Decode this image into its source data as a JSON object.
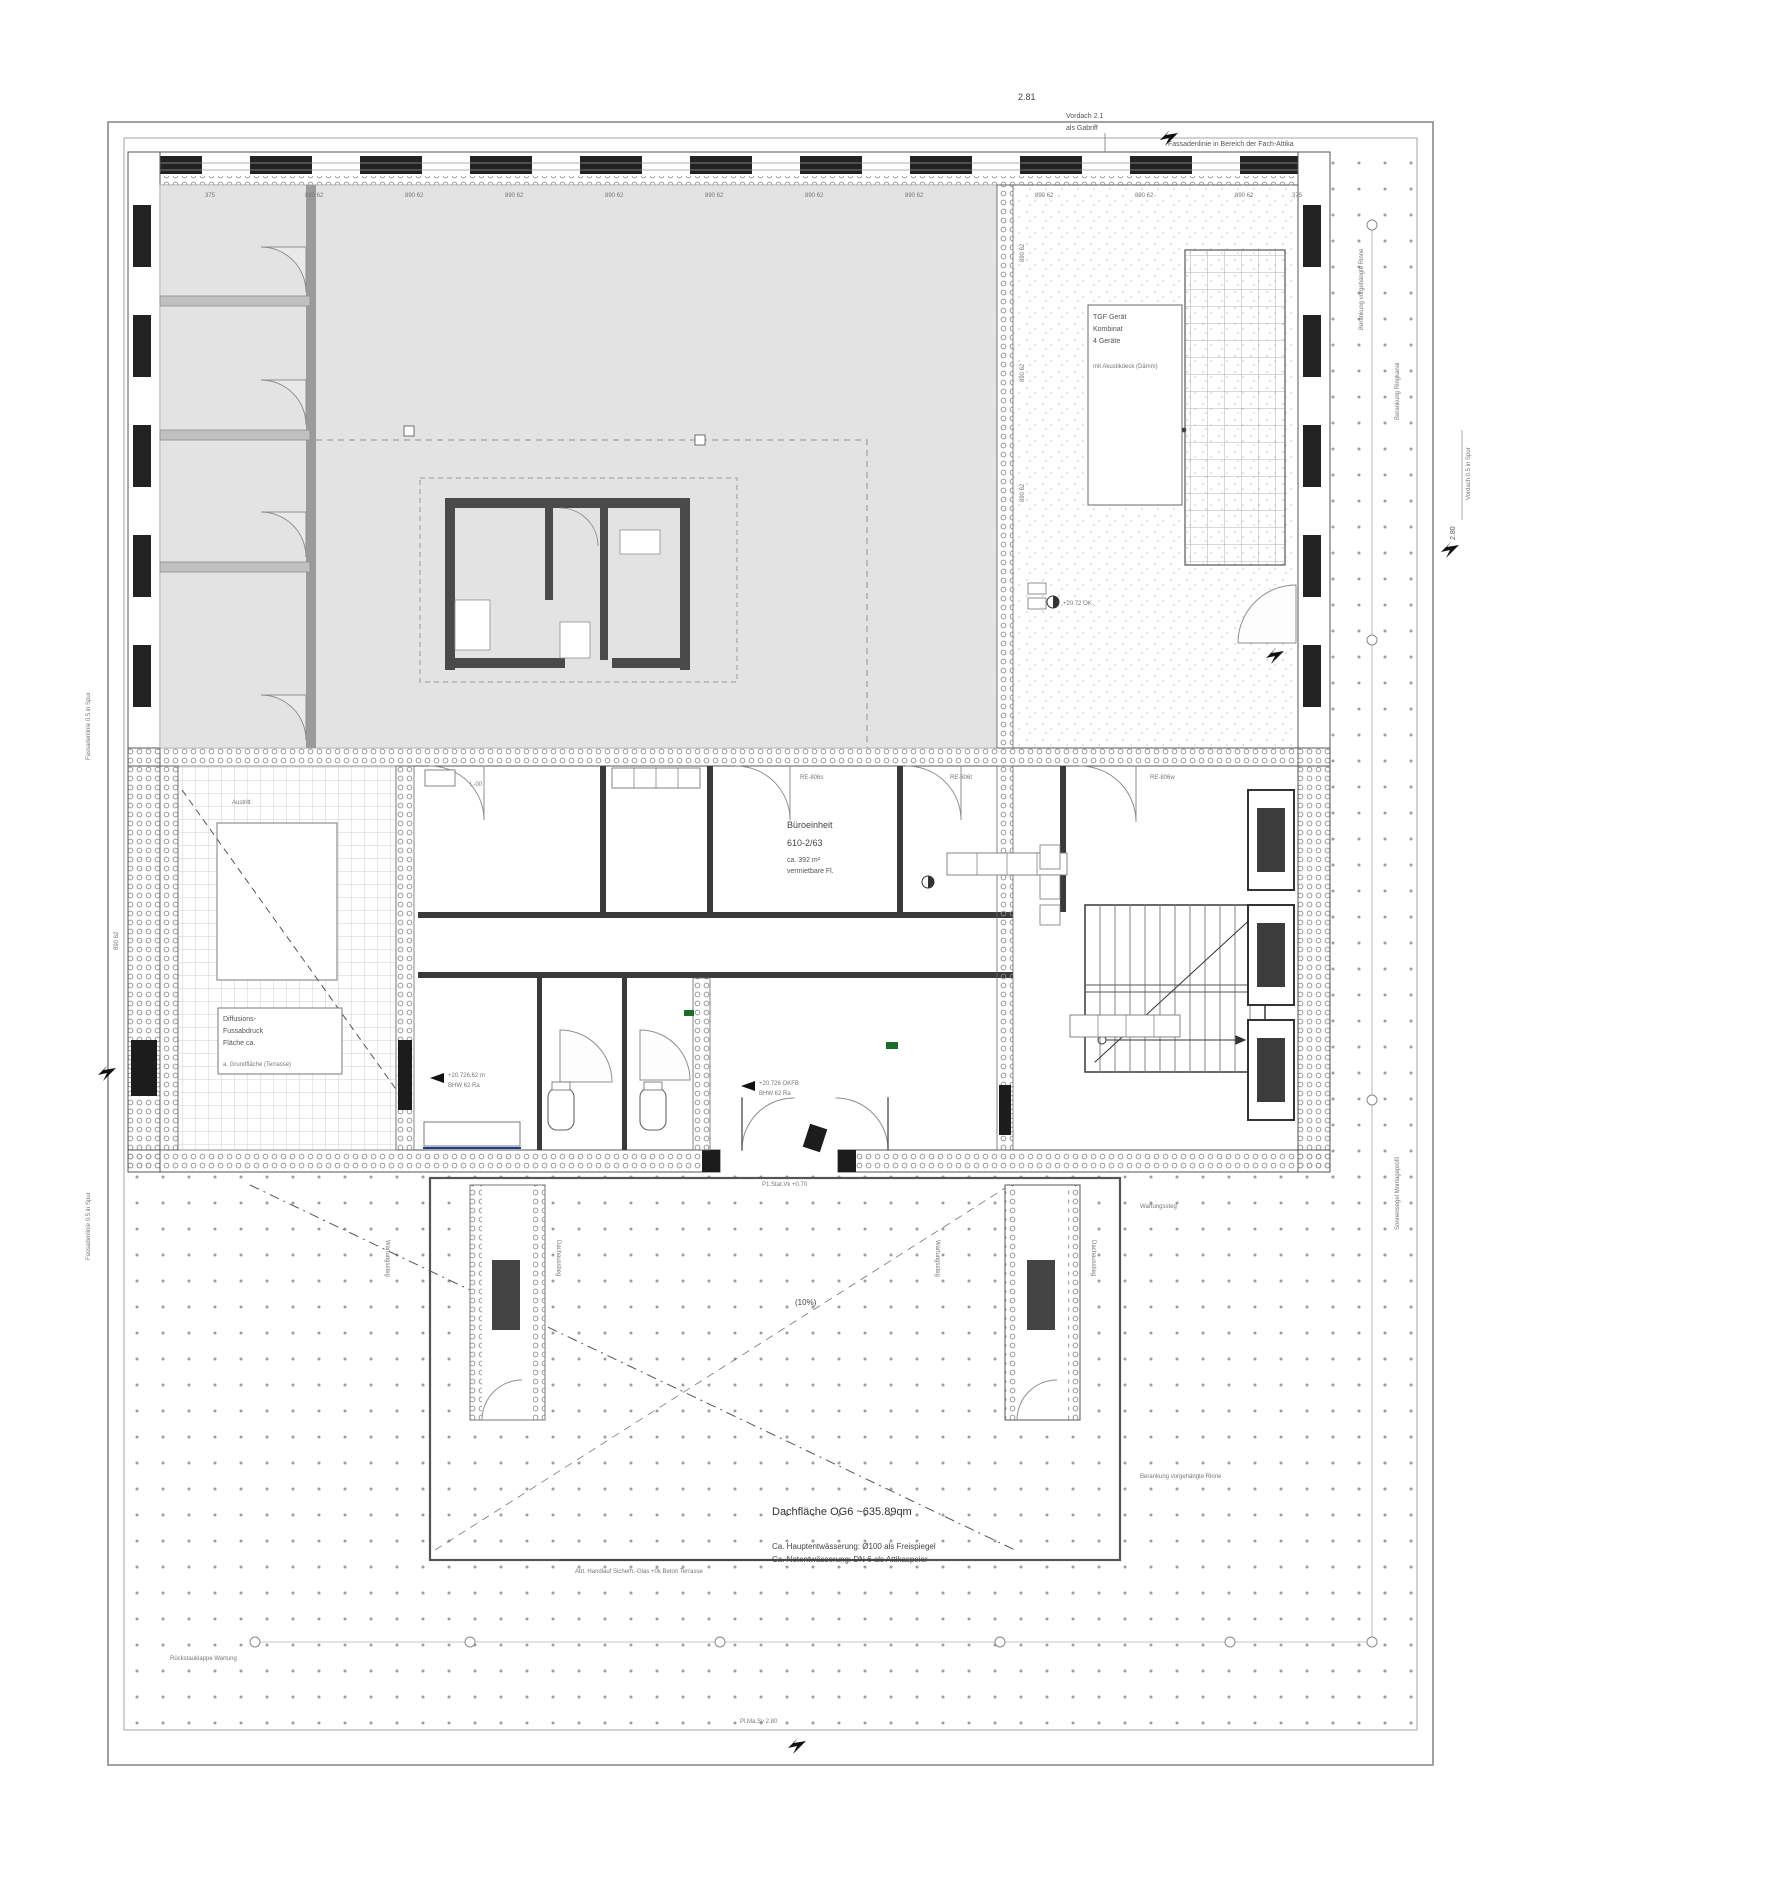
{
  "top": {
    "dim": "2.81",
    "note1": "Vordach 2.1",
    "note2": "als Gabriff",
    "fascia": "Fassadenlinie in Bereich der Fach-Attika"
  },
  "right": {
    "ringkanal": "Berankung Ringkanal",
    "rinne": "Berankung vorgehängte Rinne",
    "sonnensegel": "Sonnensegel Montageprofil",
    "dim": "2.80",
    "spur": "Vordach 0.5 in Spur"
  },
  "left": {
    "spur1": "Fassadenlinie 0.5 in Spur",
    "spur2": "Fassadenlinie 0.5 in Spur"
  },
  "techbox": {
    "lines": [
      "TGF Gerät",
      "Kombinat",
      "4 Geräte",
      "mit Akustikdeck (Dämm)"
    ]
  },
  "terrace": {
    "austritt": "Austritt",
    "box": [
      "Diffusions-",
      "Fussabdruck",
      "Fläche ca.",
      "a. Grundfläche (Terrasse)"
    ]
  },
  "unit": {
    "l1": "Büroeinheit",
    "l2": "610-2/63",
    "l3": "ca. 392 m²",
    "l4": "vermietbare Fl."
  },
  "levels": {
    "a1": "+20.726 OKFB",
    "a2": "BHW 62 Ra",
    "b1": "+20.726,62 m",
    "b2": "BHW 62 Ra",
    "c": "+20.72 OK"
  },
  "rooms": {
    "l00": "L-00",
    "r1": "RE-806s",
    "r2": "RE-806t",
    "r3": "RE-806w"
  },
  "bottom": {
    "title": "Dachfläche OG6 ~635.89qm",
    "drain1": "Ca. Hauptentwässerung: Ø100 als Freispiegel",
    "drain2": "Ca. Notentwässerung: DN 6 als Attikaspeier",
    "slope": "(10%)",
    "handrail": "Abt. Handlauf Sicherh.-Glas +0k Beton Terrasse",
    "entry": "P1.Stat.Vk +0.70",
    "plma": "Pl.Ma.Sv 2.80",
    "rueckstau": "Rückstauklappe Wartung",
    "rinne2": "Berankung vorgehängte Rinne"
  },
  "wartung": {
    "w1": "Wartungssteg",
    "w2": "Wartungssteg",
    "w3": "Wartungssteg"
  },
  "shaft": {
    "label1": "Dachausstieg",
    "label2": "Dachausstieg"
  },
  "ticks": {
    "top": [
      "375",
      "890 62",
      "890 62",
      "890 62",
      "890 62",
      "890 62",
      "890 62",
      "890 62",
      "890 62",
      "890 62",
      "890 62",
      "375"
    ],
    "left": [
      "890 62",
      "890 62",
      "890 62",
      "890 62",
      "890 62"
    ]
  },
  "colors": {
    "roof_gray": "#e3e3e3",
    "wall": "#2f2f2f",
    "accent_blue": "#1a3e8c",
    "accent_green": "#1e6b2e"
  }
}
